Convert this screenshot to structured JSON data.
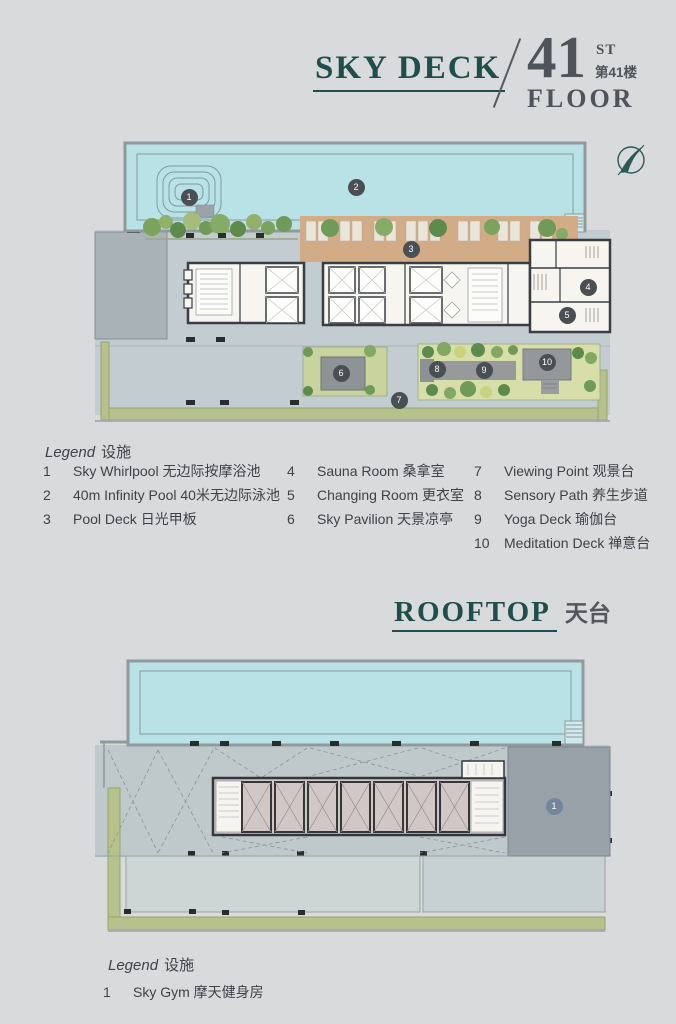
{
  "skydeck": {
    "title": "SKY DECK",
    "floor_number": "41",
    "floor_suffix": "ST",
    "floor_cn": "第41楼",
    "floor_word": "FLOOR",
    "legend_title": "Legend",
    "legend_title_cn": "设施",
    "legend": [
      {
        "n": "1",
        "label": "Sky Whirlpool 无边际按摩浴池"
      },
      {
        "n": "2",
        "label": "40m Infinity Pool 40米无边际泳池"
      },
      {
        "n": "3",
        "label": "Pool Deck 日光甲板"
      },
      {
        "n": "4",
        "label": "Sauna Room 桑拿室"
      },
      {
        "n": "5",
        "label": "Changing Room 更衣室"
      },
      {
        "n": "6",
        "label": "Sky Pavilion 天景凉亭"
      },
      {
        "n": "7",
        "label": "Viewing Point 观景台"
      },
      {
        "n": "8",
        "label": "Sensory Path 养生步道"
      },
      {
        "n": "9",
        "label": "Yoga Deck 瑜伽台"
      },
      {
        "n": "10",
        "label": "Meditation Deck 禅意台"
      }
    ],
    "markers": [
      "1",
      "2",
      "3",
      "4",
      "5",
      "6",
      "7",
      "8",
      "9",
      "10"
    ]
  },
  "rooftop": {
    "title": "ROOFTOP",
    "title_cn": "天台",
    "legend_title": "Legend",
    "legend_title_cn": "设施",
    "legend": [
      {
        "n": "1",
        "label": "Sky Gym 摩天健身房"
      }
    ],
    "markers": [
      "1"
    ]
  },
  "colors": {
    "accent_teal": "#1f4f4a",
    "title_gray": "#4e545a",
    "pool_blue": "#b9e2e7",
    "deck_gray": "#c3ccd0",
    "wood_deck": "#d2ab87",
    "garden_green": "#d7deaa",
    "border_green": "#b6c18c",
    "interior_white": "#f6f5f0",
    "wall_dark": "#3a3e42",
    "rooftop_rooms": "#d1c7c6",
    "gym_gray": "#98a1a8",
    "marker_dark": "#4a4f54",
    "marker_blue": "#74869c"
  }
}
